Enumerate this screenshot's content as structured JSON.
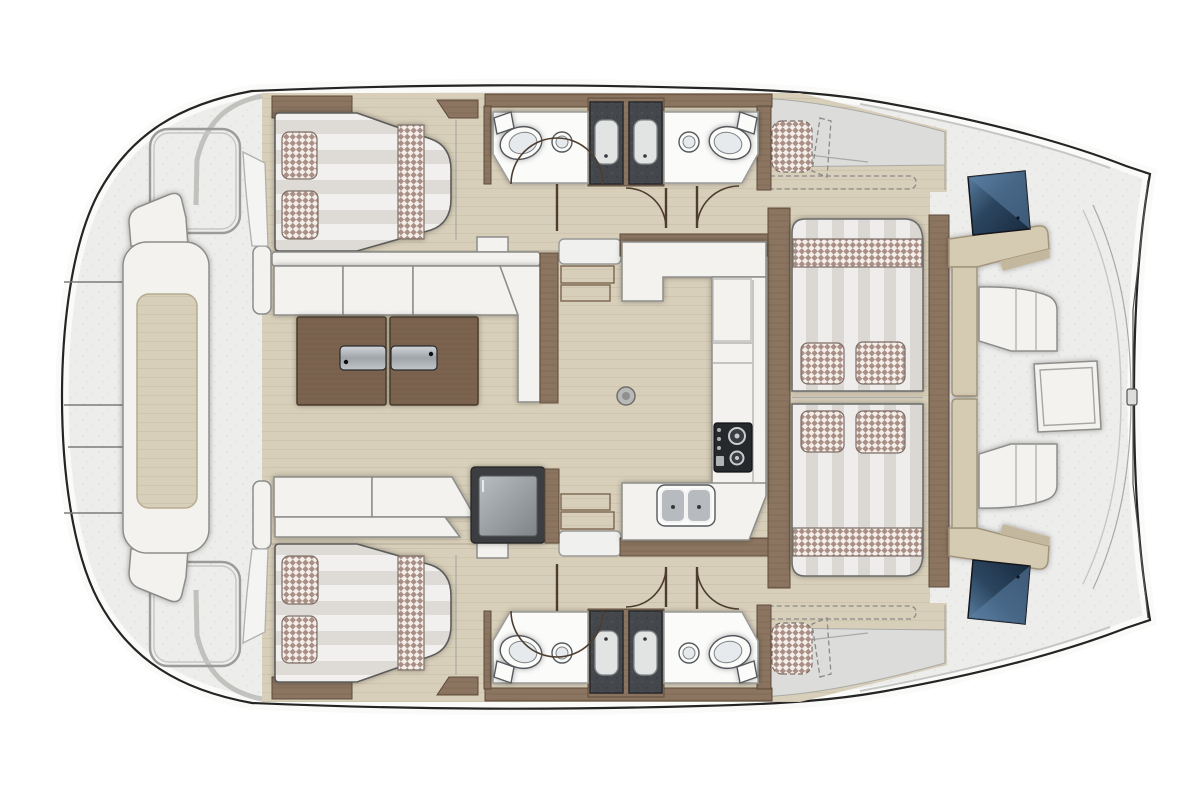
{
  "vessel": {
    "type": "catamaran-deck-plan",
    "orientation": "bow-right",
    "no_visible_text": true
  },
  "colors": {
    "hull-outline": "#242424",
    "gunwale": "#fafaf9",
    "deck": "#ededec",
    "deck-dot": "#dddddb",
    "floor": "#d8cfba",
    "floor-grain": "#c8bda4",
    "wood": "#8b7561",
    "wood-grain": "#7a6451",
    "wood-dark": "#5e4b3a",
    "table-wood": "#7b6450",
    "table-grain": "#6c5742",
    "white-furn": "#f3f2ef",
    "furn-stroke": "#8c8c8a",
    "mattress-light": "#f1f0ee",
    "mattress-shade": "#dedbd6",
    "stripe-light": "#efedeb",
    "stripe-shade": "#dbd8d3",
    "check-base": "#f3eee9",
    "check-tone": "#a98f85",
    "shower-dark": "#44484c",
    "shower-dot": "#585d61",
    "tray": "#e2e3e3",
    "porcelain": "#fbfbfa",
    "glass-deep": "#17293d",
    "glass-light": "#5d82a6",
    "bench": "#d5cab2",
    "bench-edge": "#a2947a",
    "arc": "#4d3d2f"
  },
  "features": {
    "hull_cabins": [
      {
        "name": "port-double-berth",
        "pillows": 2,
        "blanket_band": 1
      },
      {
        "name": "starboard-double-berth",
        "pillows": 2,
        "blanket_band": 1
      }
    ],
    "bathrooms": [
      {
        "name": "port-inner-head",
        "fixtures": [
          "toilet",
          "round-sink",
          "shower-column"
        ]
      },
      {
        "name": "port-outer-head",
        "fixtures": [
          "toilet",
          "round-sink",
          "shower-column"
        ]
      },
      {
        "name": "starboard-inner-head",
        "fixtures": [
          "toilet",
          "round-sink",
          "shower-column"
        ]
      },
      {
        "name": "starboard-outer-head",
        "fixtures": [
          "toilet",
          "round-sink",
          "shower-column"
        ]
      }
    ],
    "salon": {
      "sofas": 2,
      "table_leaves": 2,
      "table_handles": 2,
      "fridge": 1,
      "floor_socket": 1
    },
    "galley": {
      "shape": "U",
      "burners": 2,
      "sink_basins": 2
    },
    "lounge": {
      "mattresses": 2,
      "pillows": 4,
      "checkered_bands": 2
    },
    "bow_cockpit": {
      "benches": 2,
      "glass_hatches": 2,
      "center_hatch": 1
    },
    "aft_deck": {
      "console": 1,
      "deck_hatch_outlines": 2,
      "seam_lines": 4
    },
    "doors": 6,
    "stair_flights": 2,
    "optional_dashed_items": 4
  }
}
